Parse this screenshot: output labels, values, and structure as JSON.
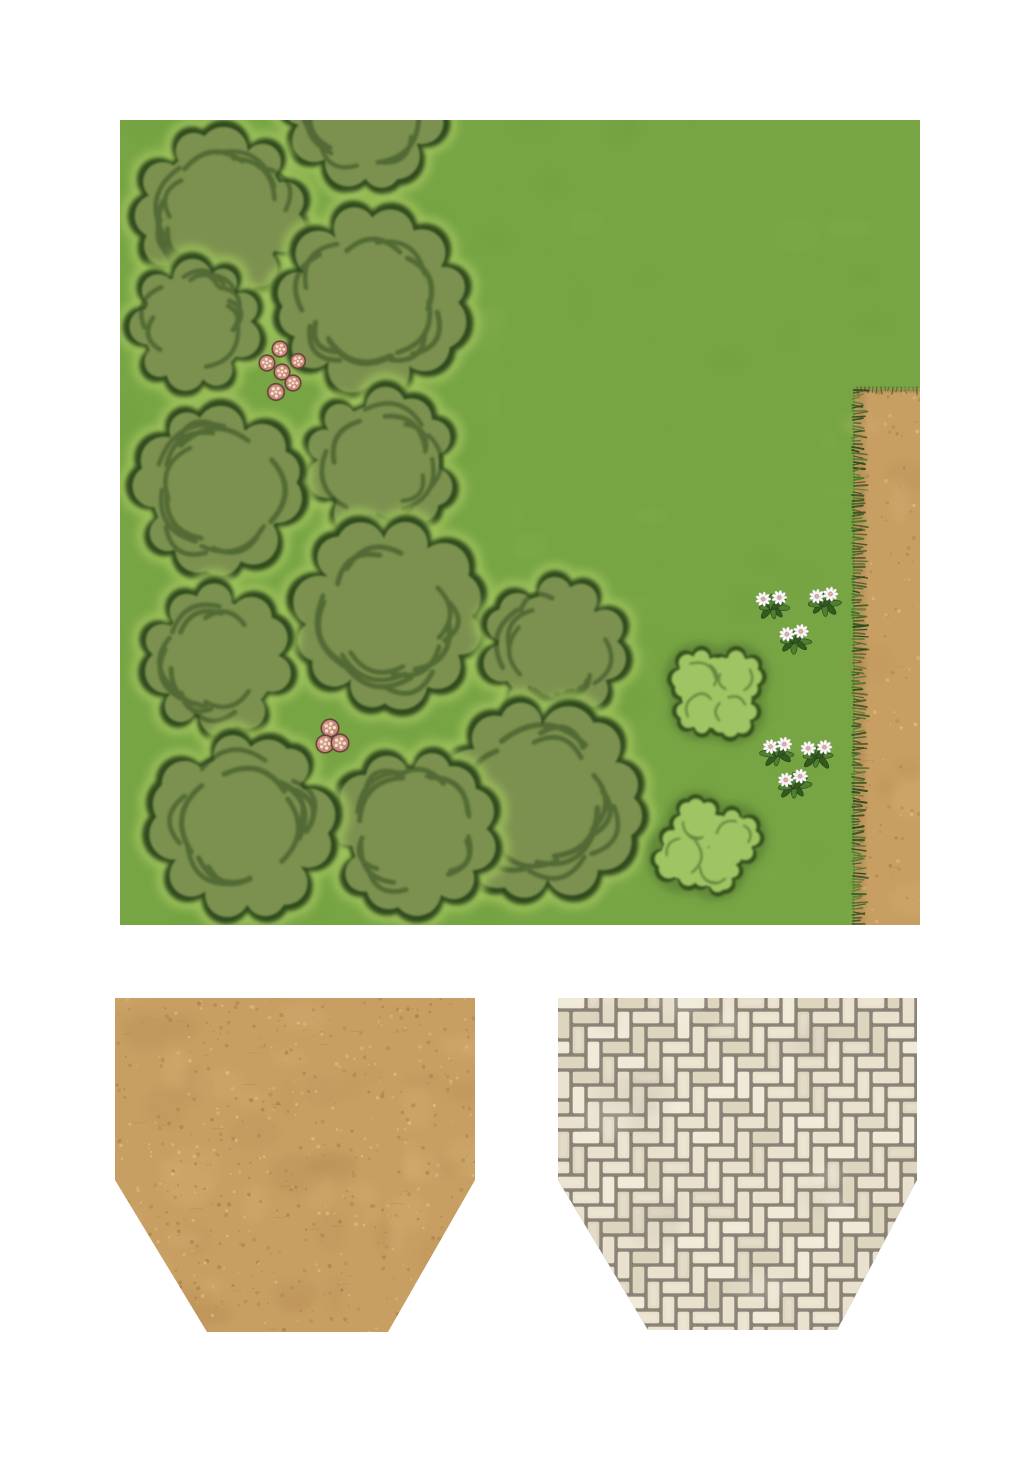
{
  "document": {
    "type": "printable-map-tile-sheet",
    "background": "#ffffff",
    "width": 1033,
    "height": 1462
  },
  "map": {
    "label": "grass-woodland-map-tile-with-dirt-path",
    "x": 120,
    "y": 120,
    "width": 800,
    "height": 805,
    "colors": {
      "grass": "#78a544",
      "grassMottleDark": "#6a9a3a",
      "grassMottleLight": "#8ab354",
      "treeFill": "#7b9150",
      "treeOutline": "#2f4a1e",
      "treeMark": "#2c451c",
      "treeHalo": "#a3c55f",
      "bushFill": "#9fc463",
      "bushOutline": "#35511f",
      "bushShadow": "#4a6c2e",
      "dirt": "#c89f63",
      "dirtSpeckleDark": "#aa8048",
      "dirtSpeckleLight": "#e0bd82",
      "dirtShade": "#9a7546",
      "fringeDark": "#2d4a1e",
      "fringeMid": "#3d6026",
      "fringeLight": "#4e7a2e",
      "mushroomCap": "#c8897b",
      "mushroomCapLight": "#d99d8d",
      "mushroomRim": "#64453c",
      "mushroomSpot": "#f2e0ca",
      "petal": "#fbfbf8",
      "petalEdge": "#c6c0cc",
      "flowerCenter": "#cf9fc0",
      "flowerDot": "#e9c445",
      "leafDark": "#33591f",
      "leafLight": "#4f7f31"
    },
    "trees": [
      {
        "x": 100,
        "y": 93,
        "r": 90
      },
      {
        "x": 245,
        "y": -10,
        "r": 84
      },
      {
        "x": 75,
        "y": 205,
        "r": 70
      },
      {
        "x": 252,
        "y": 182,
        "r": 99
      },
      {
        "x": 98,
        "y": 370,
        "r": 89
      },
      {
        "x": 261,
        "y": 343,
        "r": 79
      },
      {
        "x": 269,
        "y": 494,
        "r": 99
      },
      {
        "x": 98,
        "y": 540,
        "r": 79
      },
      {
        "x": 434,
        "y": 530,
        "r": 76
      },
      {
        "x": 122,
        "y": 706,
        "r": 97
      },
      {
        "x": 294,
        "y": 712,
        "r": 86
      },
      {
        "x": 421,
        "y": 681,
        "r": 104
      }
    ],
    "bushes": [
      {
        "x": 598,
        "y": 573,
        "r": 50,
        "lobes": 4
      },
      {
        "x": 588,
        "y": 725,
        "r": 52,
        "lobes": 4
      }
    ],
    "mushroom_clusters": [
      {
        "mushrooms": [
          {
            "x": 160,
            "y": 229,
            "r": 7
          },
          {
            "x": 178,
            "y": 241,
            "r": 6.5
          },
          {
            "x": 147,
            "y": 243,
            "r": 7
          },
          {
            "x": 162,
            "y": 252,
            "r": 7
          },
          {
            "x": 173,
            "y": 263,
            "r": 7
          },
          {
            "x": 156,
            "y": 272,
            "r": 7.5
          }
        ]
      },
      {
        "mushrooms": [
          {
            "x": 210,
            "y": 608,
            "r": 8
          },
          {
            "x": 205,
            "y": 624,
            "r": 8
          },
          {
            "x": 220,
            "y": 623,
            "r": 8
          }
        ]
      }
    ],
    "flower_clusters": [
      {
        "plants": [
          {
            "x": 652,
            "y": 487
          },
          {
            "x": 704,
            "y": 484
          },
          {
            "x": 674,
            "y": 521
          }
        ]
      },
      {
        "plants": [
          {
            "x": 658,
            "y": 634
          },
          {
            "x": 697,
            "y": 636
          },
          {
            "x": 674,
            "y": 666
          }
        ]
      }
    ],
    "path": {
      "x": 735,
      "y": 268,
      "width": 65,
      "height": 537,
      "edge": "grass-fringe-left-and-top"
    }
  },
  "dirt_swatch": {
    "label": "dirt-texture-swatch",
    "x": 115,
    "y": 995,
    "width": 362,
    "height": 340,
    "polygon": "0,3 360,3 360,185 273,337 92,337 0,185",
    "colors": {
      "base": "#c89f63",
      "speckleDark": "#aa8048",
      "speckleLight": "#e0bd82",
      "mottle": "#b8905a"
    }
  },
  "paver_swatch": {
    "label": "stone-paver-texture-swatch",
    "x": 556,
    "y": 995,
    "width": 363,
    "height": 338,
    "polygon": "2,3 361,3 361,185 281,335 92,335 2,185",
    "pattern": "herringbone",
    "brick_unit": 15,
    "colors": {
      "mortar": "#8b8377",
      "mortarDark": "#6f675c",
      "brick1": "#e9e1cd",
      "brick2": "#ded5bf",
      "brick3": "#f0e9d8",
      "brick4": "#e3dbc6",
      "brickHighlight": "#f6f0df"
    }
  }
}
